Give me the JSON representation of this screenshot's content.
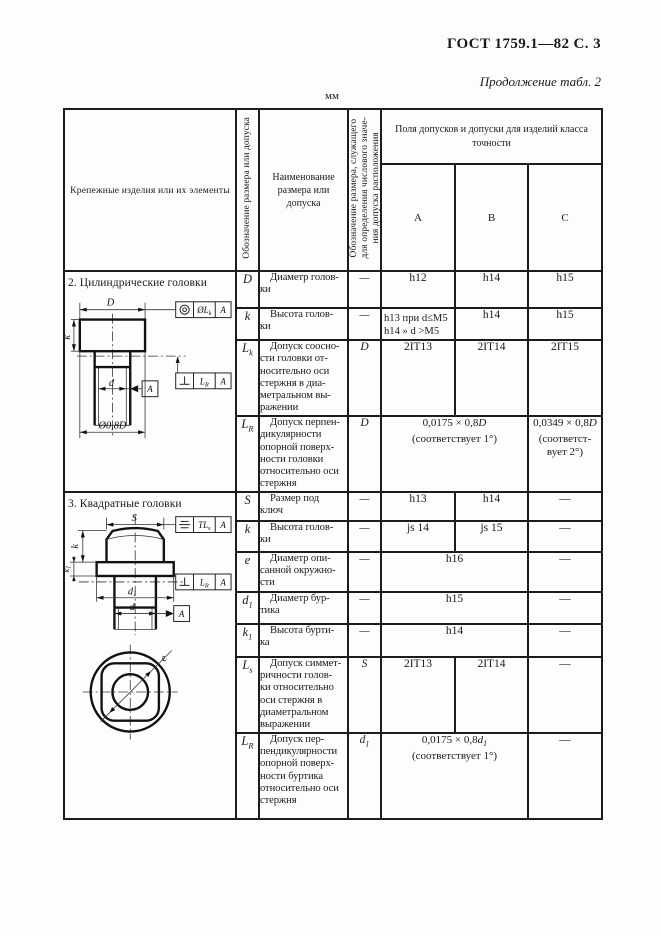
{
  "page": {
    "header_right": "ГОСТ 1759.1—82 С. 3",
    "continuation": "Продолжение табл. 2",
    "units": "мм"
  },
  "icons": {
    "concentricity": "◎",
    "perpendicularity": "⊥",
    "symmetry": "≡",
    "diameter": "Ø"
  },
  "table": {
    "head": {
      "items": "Крепежные изделия или их элементы",
      "sym": "Обозначение размера или допуска",
      "name": "Наименование\nразмера или\nдопуска",
      "ref": "Обозначение размера, служащего\nдля определения числового значе-\nния допуска расположения",
      "tol": "Поля допусков и допуски для изделий класса\nточности",
      "a": "А",
      "b": "В",
      "c": "С"
    },
    "rows": {
      "d": {
        "sym": "D",
        "sub": "",
        "name": "Диаметр голов-\nки",
        "ref": "—",
        "a": "h12",
        "b": "h14",
        "c": "h15"
      },
      "k_cyl": {
        "sym": "k",
        "sub": "",
        "name": "Высота голов-\nки",
        "ref": "—",
        "a": "h13 при d≤M5\nh14  »  d >M5",
        "b": "h14",
        "c": "h15"
      },
      "lk": {
        "sym": "L",
        "sub": "k",
        "name": "Допуск соосно-\nсти головки от-\nносительно оси\nстержня в диа-\nметральном вы-\nражении",
        "ref": "D",
        "a": "2IT13",
        "b": "2IT14",
        "c": "2IT15"
      },
      "lr_cyl": {
        "sym": "L",
        "sub": "R",
        "name": "Допуск перпен-\nдикулярности\nопорной поверх-\nности головки\nотносительно оси\nстержня",
        "ref": "D",
        "ab_pre": "0,0175 × 0,8",
        "ab_var": "D",
        "ab_sub": "",
        "ab_note": "(соответствует 1°)",
        "c_pre": "0,0349 × 0,8",
        "c_var": "D",
        "c_sub": "",
        "c_note": "(соответст-\nвует 2°)"
      },
      "s": {
        "sym": "S",
        "sub": "",
        "name": "Размер под\nключ",
        "ref": "—",
        "a": "h13",
        "b": "h14",
        "c": "—"
      },
      "k_sq": {
        "sym": "k",
        "sub": "",
        "name": "Высота голов-\nки",
        "ref": "—",
        "a": "js 14",
        "b": "js 15",
        "c": "—"
      },
      "e": {
        "sym": "e",
        "sub": "",
        "name": "Диаметр опи-\nсанной окружно-\nсти",
        "ref": "—",
        "ab": "h16",
        "c": "—"
      },
      "d1": {
        "sym": "d",
        "sub": "1",
        "name": "Диаметр бур-\nтика",
        "ref": "—",
        "ab": "h15",
        "c": "—"
      },
      "k1": {
        "sym": "k",
        "sub": "1",
        "name": "Высота бурти-\nка",
        "ref": "—",
        "ab": "h14",
        "c": "—"
      },
      "ls": {
        "sym": "L",
        "sub": "s",
        "name": "Допуск симмет-\nричности голов-\nки относительно\nоси стержня в\nдиаметральном\nвыражении",
        "ref": "S",
        "a": "2IT13",
        "b": "2IT14",
        "c": "—"
      },
      "lr_sq": {
        "sym": "L",
        "sub": "R",
        "name": "Допуск пер-\nпендикулярности\nопорной поверх-\nности буртика\nотносительно оси\nстержня",
        "ref": "d",
        "ref_sub": "1",
        "ab_pre": "0,0175 × 0,8",
        "ab_var": "d",
        "ab_sub": "1",
        "ab_note": "(соответствует 1°)",
        "c": "—"
      }
    }
  },
  "drawings": {
    "cyl": {
      "caption": "2. Цилиндрические головки",
      "dim_head": "D",
      "dim_height": "k",
      "dim_rod": "d",
      "dim_bearing": "Ø0,8D",
      "frame1": {
        "label": "ØL",
        "sub": "k",
        "datum": "A"
      },
      "frame2": {
        "label": "L",
        "sub": "R",
        "datum": "A"
      },
      "datum": "A"
    },
    "sq": {
      "caption": "3. Квадратные головки",
      "dim_s": "S",
      "dim_k": "k",
      "dim_k1": "k",
      "dim_k1_sub": "1",
      "dim_d1": "d",
      "dim_d1_sub": "1",
      "dim_rod": "d",
      "dim_e": "e",
      "frame1": {
        "label": "TL",
        "sub": "s",
        "datum": "A"
      },
      "frame2": {
        "label": "L",
        "sub": "R",
        "datum": "A"
      },
      "datum": "A"
    }
  }
}
